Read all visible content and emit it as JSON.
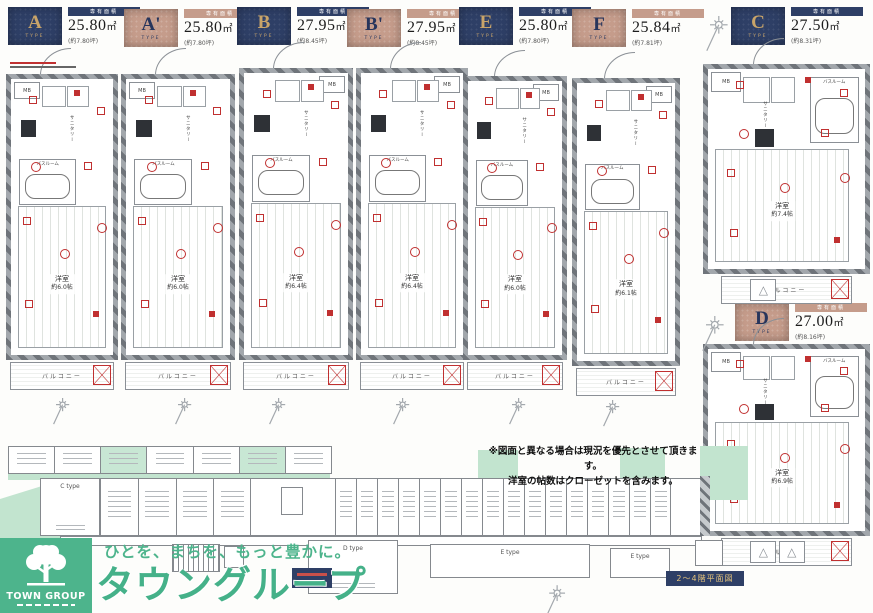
{
  "colors": {
    "navy": "#2e3f66",
    "beige": "#c59c8b",
    "gold": "#c9a469",
    "green": "#4db48c",
    "light_green": "#c2e4cf",
    "red": "#c03030",
    "wall_gray": "#878c91"
  },
  "header": {
    "area_caption": "専有面積",
    "type_word": "TYPE",
    "types": [
      {
        "letter": "A",
        "area_value": "25.80",
        "area_unit": "㎡",
        "tsubo": "(約7.80坪)",
        "style": "navy"
      },
      {
        "letter": "A'",
        "area_value": "25.80",
        "area_unit": "㎡",
        "tsubo": "(約7.80坪)",
        "style": "beige"
      },
      {
        "letter": "B",
        "area_value": "27.95",
        "area_unit": "㎡",
        "tsubo": "(約8.45坪)",
        "style": "navy"
      },
      {
        "letter": "B'",
        "area_value": "27.95",
        "area_unit": "㎡",
        "tsubo": "(約8.45坪)",
        "style": "beige"
      },
      {
        "letter": "E",
        "area_value": "25.80",
        "area_unit": "㎡",
        "tsubo": "(約7.80坪)",
        "style": "navy"
      },
      {
        "letter": "F",
        "area_value": "25.84",
        "area_unit": "㎡",
        "tsubo": "(約7.81坪)",
        "style": "beige"
      },
      {
        "letter": "C",
        "area_value": "27.50",
        "area_unit": "㎡",
        "tsubo": "(約8.31坪)",
        "style": "navy"
      },
      {
        "letter": "D",
        "area_value": "27.00",
        "area_unit": "㎡",
        "tsubo": "(約8.16坪)",
        "style": "beige"
      }
    ]
  },
  "plan_labels": {
    "mb": "MB",
    "bath": "バスルーム",
    "sanitary": "サニタリー",
    "room": "洋室",
    "balcony": "バルコニー"
  },
  "plans": [
    {
      "name": "A",
      "size": "約6.0帖"
    },
    {
      "name": "A'",
      "size": "約6.0帖"
    },
    {
      "name": "B",
      "size": "約6.4帖"
    },
    {
      "name": "B'",
      "size": "約6.4帖"
    },
    {
      "name": "E",
      "size": "約6.0帖"
    },
    {
      "name": "F",
      "size": "約6.1帖"
    },
    {
      "name": "C",
      "size": "約7.4帖"
    },
    {
      "name": "D",
      "size": "約6.9帖"
    }
  ],
  "notes": {
    "line1": "※図面と異なる場合は現況を優先とさせて頂きます。",
    "line2": "洋室の帖数はクローゼットを含みます。"
  },
  "site_plan": {
    "badge": "2〜4階平面図",
    "blocks": {
      "c": "C type",
      "d": "D type",
      "e1": "E type",
      "e2": "E type"
    }
  },
  "logo": {
    "tagline": "ひとを、まちを、もっと豊かに。",
    "brand": "タウングループ",
    "mark": "TOWN GROUP"
  }
}
